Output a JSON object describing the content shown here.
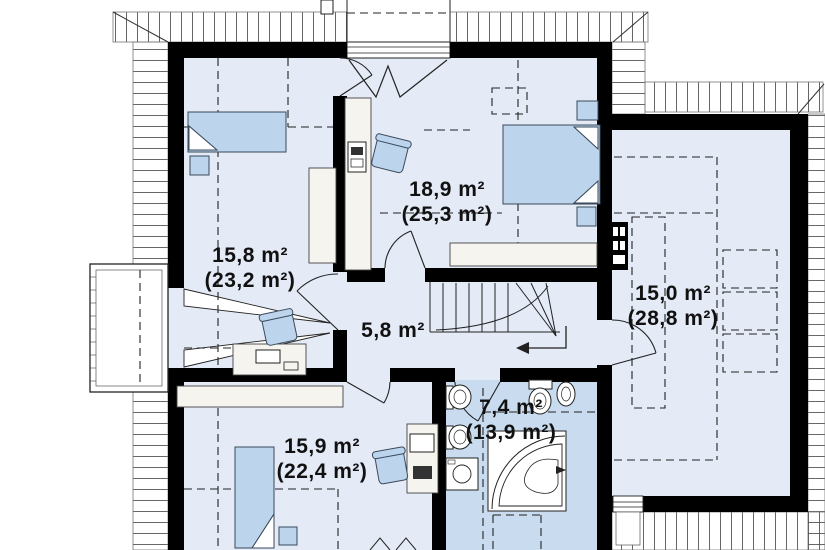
{
  "plan": {
    "type": "attic-floor-plan",
    "rooms": [
      {
        "id": "bedroom-top-left",
        "area": "15,8 m²",
        "total": "(23,2 m²)"
      },
      {
        "id": "bedroom-top-middle",
        "area": "18,9 m²",
        "total": "(25,3 m²)"
      },
      {
        "id": "room-right",
        "area": "15,0 m²",
        "total": "(28,8 m²)"
      },
      {
        "id": "hallway",
        "area": "5,8 m²",
        "total": ""
      },
      {
        "id": "bedroom-bottom-left",
        "area": "15,9 m²",
        "total": "(22,4 m²)"
      },
      {
        "id": "bathroom",
        "area": "7,4 m²",
        "total": "(13,9 m²)"
      }
    ],
    "colors": {
      "wall": "#000000",
      "room_fill": "#e4eaf6",
      "bathroom_fill": "#c9dcef",
      "furniture_fill": "#bcd4ec",
      "furniture_outline": "#3a4a5c",
      "label": "#111111",
      "background": "#ffffff"
    }
  }
}
